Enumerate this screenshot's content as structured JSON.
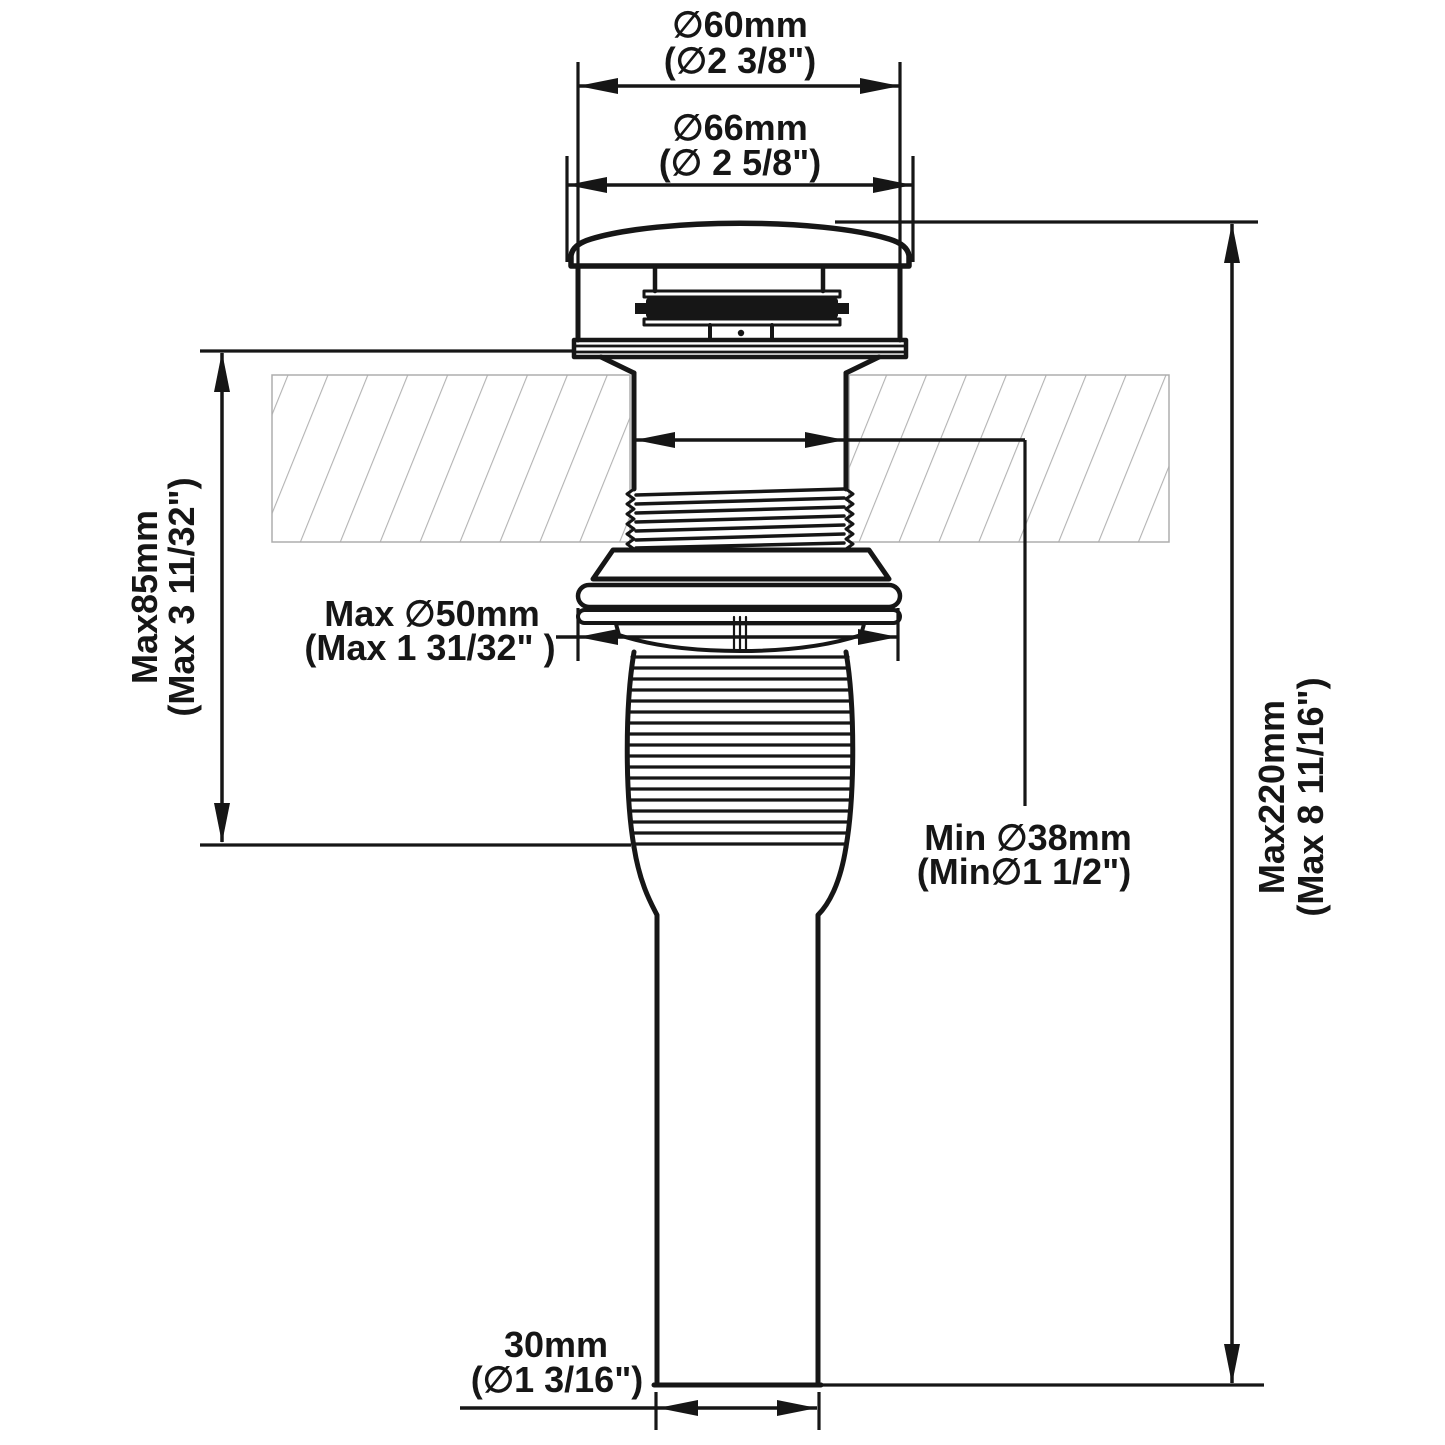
{
  "drawing": {
    "type": "technical dimension drawing",
    "subject": "pop-up sink drain with overflow, section through countertop",
    "line_color": "#161616",
    "hatch_color": "#b3b3b3",
    "background_color": "#ffffff"
  },
  "dims": {
    "d60": {
      "mm": "∅60mm",
      "in": "(∅2 3/8\")"
    },
    "d66": {
      "mm": "∅66mm",
      "in": "(∅ 2 5/8\")"
    },
    "h85": {
      "mm": "Max85mm",
      "in": "(Max 3 11/32\")"
    },
    "d50": {
      "mm": "Max ∅50mm",
      "in": "(Max 1 31/32\" )"
    },
    "d38": {
      "mm": "Min ∅38mm",
      "in": "(Min∅1 1/2\")"
    },
    "h220": {
      "mm": "Max220mm",
      "in": "(Max 8 11/16\")"
    },
    "d30": {
      "mm": "30mm",
      "in": "(∅1 3/16\")"
    }
  }
}
